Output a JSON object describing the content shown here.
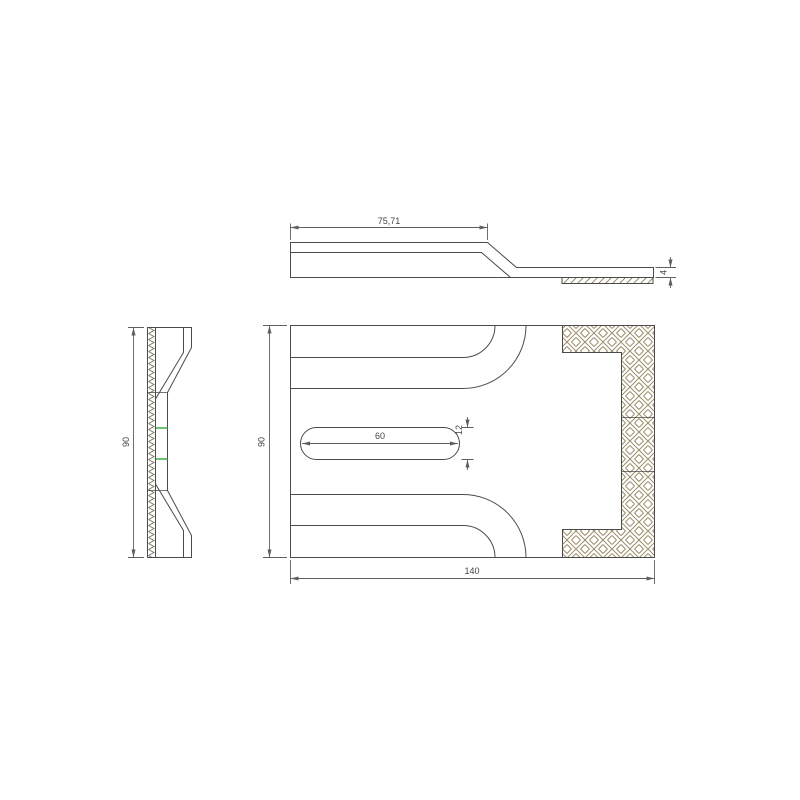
{
  "colors": {
    "line": "#4b4b4b",
    "dim": "#5f5f5f",
    "text": "#454545",
    "hatch-basket": "#97855f",
    "hatch-diag": "#8a7a58",
    "hatch-zigzag": "#6e6552",
    "highlight": "#3fae49",
    "background": "#ffffff"
  },
  "dims": {
    "top_length": "75,71",
    "top_thickness": "4",
    "side_height": "90",
    "front_height": "90",
    "front_width": "140",
    "slot_length": "60",
    "slot_width": "12"
  }
}
